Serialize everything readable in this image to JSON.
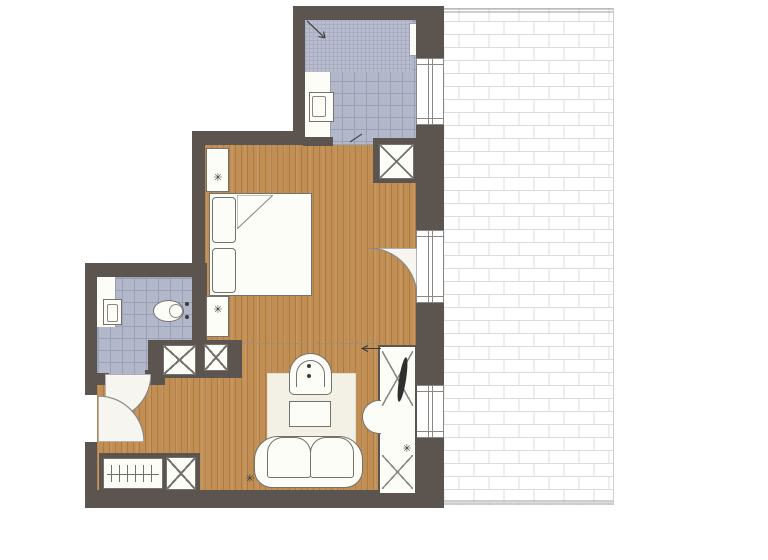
{
  "document": {
    "kind": "apartment-floor-plan",
    "canvas": {
      "width": 768,
      "height": 560
    },
    "visible_text": []
  },
  "colors": {
    "wall": "#5b544f",
    "wood": "#c18e54",
    "tile": "#b2b7ca",
    "tile-line": "#9aa0b6",
    "mosaic": "#b9bdcf",
    "mosaic-line": "#a8adc2",
    "fixture": "#fdfdf8",
    "line": "#75716c",
    "rug": "#f3f0e6",
    "door": "#f7f5ef",
    "brick-line": "#dcdcdc",
    "terrace-border": "#9c9c9c",
    "dash": "#8f8f8f",
    "dark": "#2f2f2f"
  },
  "icons": {
    "plant": "✳"
  },
  "legend": {
    "rooms": [
      "bathroom",
      "wc",
      "bedroom",
      "living-area",
      "entry-hall",
      "terrace"
    ],
    "floor_finishes": [
      "mosaic-tile-shower",
      "ceramic-tile",
      "wood-plank",
      "brick-paver-terrace"
    ],
    "furniture": [
      "double-bed",
      "pillows",
      "nightstands",
      "shower",
      "washbasin",
      "toilet",
      "wardrobe",
      "shaft-boxes",
      "rug",
      "armchair",
      "coffee-table",
      "sofa",
      "tall-cabinet",
      "half-round-table",
      "doors-with-swing",
      "windows"
    ]
  }
}
